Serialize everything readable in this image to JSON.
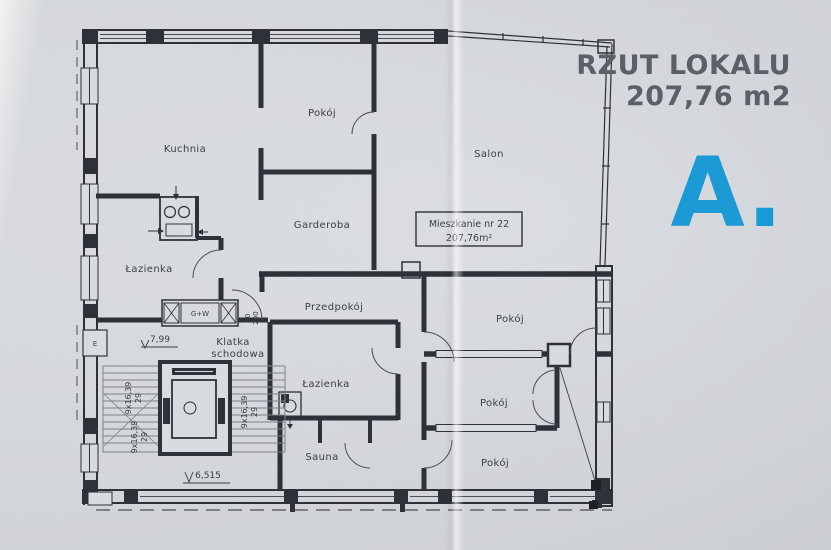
{
  "header": {
    "title_line1": "RZUT LOKALU",
    "title_line2": "207,76 m2",
    "plan_letter": "A."
  },
  "colors": {
    "accent": "#1b9ad6",
    "title_text": "#5a6067",
    "paper": "#d8dbdf",
    "ink": "#2e3238"
  },
  "plan": {
    "unit_label": {
      "line1": "Mieszkanie nr 22",
      "line2": "207,76m²"
    },
    "rooms": {
      "kuchnia": "Kuchnia",
      "pokoj_top": "Pokój",
      "salon": "Salon",
      "garderoba": "Garderoba",
      "lazienka_left": "Łazienka",
      "przedpokoj": "Przedpokój",
      "klatka_line1": "Klatka",
      "klatka_line2": "schodowa",
      "lazienka_mid": "Łazienka",
      "sauna": "Sauna",
      "pokoj_right_top": "Pokój",
      "pokoj_right_mid": "Pokój",
      "pokoj_right_bottom": "Pokój"
    },
    "annotations": {
      "shaft": "G+W",
      "electric": "E",
      "level_mid": "7,99",
      "level_low": "6,515",
      "door_width": "90",
      "door_height": "200",
      "stair_run": "9x16,39",
      "stair_rise": "29"
    }
  }
}
